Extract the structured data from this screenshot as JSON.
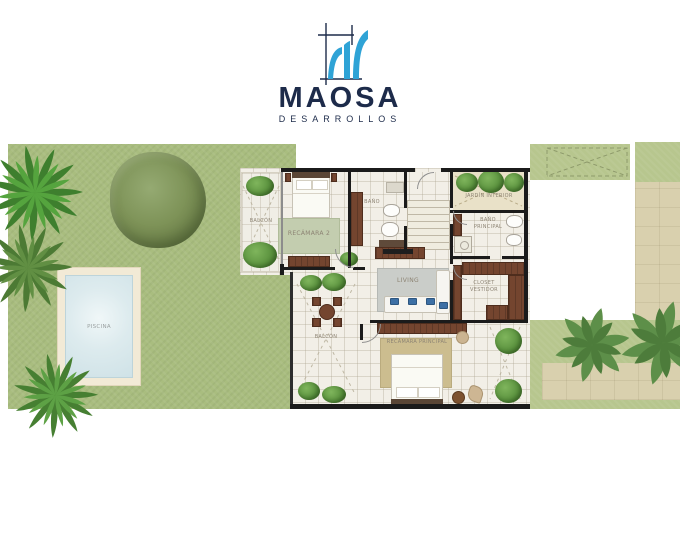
{
  "brand": {
    "name": "MAOSA",
    "tagline": "DESARROLLOS",
    "icon": "maosa-m-drafting-icon",
    "blue": "#2fa3d6",
    "navy": "#1d2b4a"
  },
  "plan": {
    "rooms": {
      "balcon_upper": "BALCÓN",
      "recamara2": "RECÁMARA 2",
      "bano": "BAÑO",
      "jardin_interior": "JARDÍN INTERIOR",
      "bano_principal": "BAÑO PRINCIPAL",
      "closet_vestidor": "CLOSET VESTIDOR",
      "living": "LIVING",
      "balcon_lower": "BALCÓN",
      "recamara_principal": "RECÁMARA PRINCIPAL"
    },
    "outdoor": {
      "piscina": "PISCINA"
    },
    "palette": {
      "grass_left": "#a9bd7f",
      "grass_right": "#b7c68e",
      "stone_path": "#d9d0ae",
      "floor_tile": "#f2efe7",
      "wall": "#1b1b1b",
      "wood_furniture": "#74452f",
      "rug_bedroom2": "#c3cdaf",
      "rug_living": "#cacdc9",
      "rug_master": "#ccbd8f",
      "pool_water": "#d9e9ec",
      "pool_deck": "#f2ead6"
    }
  }
}
